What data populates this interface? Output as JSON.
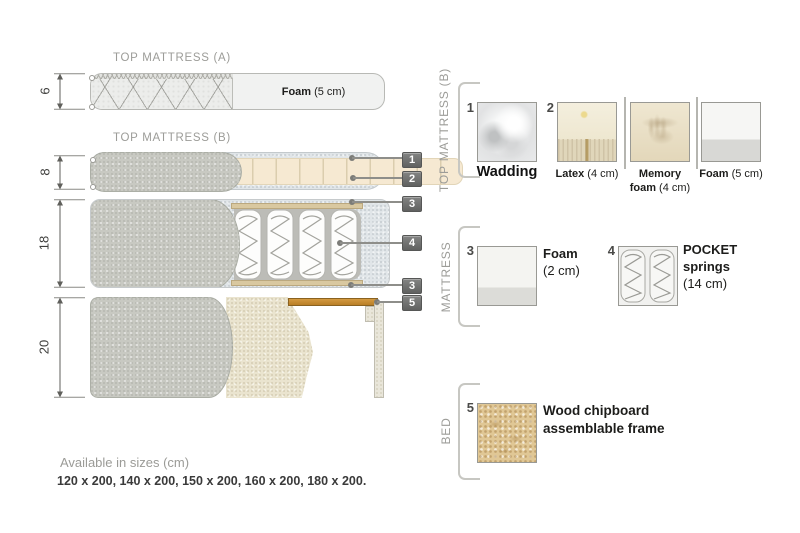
{
  "diagram": {
    "titles": {
      "top_a": "TOP MATTRESS (A)",
      "top_b": "TOP MATTRESS (B)"
    },
    "foam_label": {
      "bold": "Foam",
      "note": "(5 cm)"
    },
    "dimensions": [
      {
        "value": "6"
      },
      {
        "value": "8"
      },
      {
        "value": "18"
      },
      {
        "value": "20"
      }
    ],
    "callouts": [
      {
        "num": "1"
      },
      {
        "num": "2"
      },
      {
        "num": "3"
      },
      {
        "num": "4"
      },
      {
        "num": "3"
      },
      {
        "num": "5"
      }
    ]
  },
  "legend": {
    "sections": [
      {
        "label": "TOP MATTRESS (B)"
      },
      {
        "label": "MATTRESS"
      },
      {
        "label": "BED"
      }
    ],
    "items": [
      {
        "num": "1",
        "name": "Wadding"
      },
      {
        "num": "2",
        "bold": "Latex",
        "note": "(4 cm)"
      },
      {
        "bold1": "Memory",
        "bold2": "foam",
        "note": "(4 cm)"
      },
      {
        "bold": "Foam",
        "note": "(5 cm)"
      },
      {
        "num": "3",
        "bold": "Foam",
        "note": "(2 cm)"
      },
      {
        "num": "4",
        "bold1": "POCKET",
        "bold2": "springs",
        "note": "(14 cm)"
      },
      {
        "num": "5",
        "line1": "Wood chipboard",
        "line2": "assemblable frame"
      }
    ]
  },
  "footer": {
    "availability_title": "Available in sizes (cm)",
    "sizes": "120 x 200, 140 x 200, 150 x 200, 160 x 200, 180 x 200."
  },
  "colors": {
    "fabric_gray": "#c8c9c2",
    "foam_beige": "#f6e9d2",
    "wadding_blue_gray": "#e0e5e8",
    "wood_plank": "#c9913a",
    "badge_bg": "#6f706f",
    "label_gray": "#9c9c98",
    "text_dark": "#1d1d1b"
  }
}
